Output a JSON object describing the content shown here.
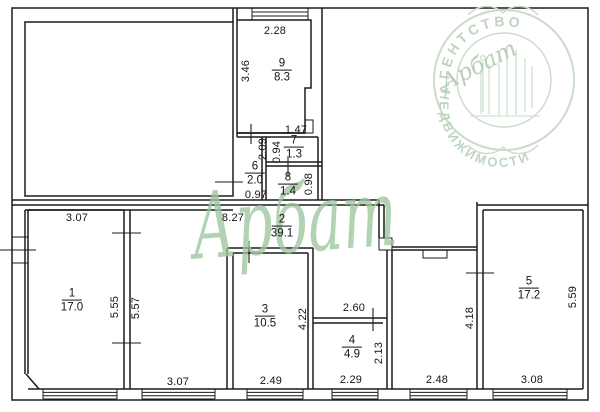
{
  "watermark": {
    "text": "Арбат"
  },
  "logo": {
    "top_text": "АГЕНТСТВО",
    "bottom_text": "НЕДВИЖИМОСТИ",
    "brand_script": "Арбат"
  },
  "colors": {
    "wall": "#1b1b1b",
    "watermark_green": "#9ec69e",
    "logo_green": "#c3d8c3"
  },
  "rooms": [
    {
      "number": "9",
      "area": "8.3"
    },
    {
      "number": "7",
      "area": "1.3"
    },
    {
      "number": "6",
      "area": "2.0"
    },
    {
      "number": "8",
      "area": "1.4"
    },
    {
      "number": "2",
      "area": "39.1"
    },
    {
      "number": "1",
      "area": "17.0"
    },
    {
      "number": "3",
      "area": "10.5"
    },
    {
      "number": "4",
      "area": "4.9"
    },
    {
      "number": "5",
      "area": "17.2"
    }
  ],
  "dims": {
    "room9_width": "2.28",
    "room9_depth": "3.46",
    "room7_width": "1.47",
    "room7_depth": "0.94",
    "room6_depth": "2.09",
    "room6_width": "0.97",
    "room8_depth": "0.98",
    "corridor_length": "8.27",
    "room1_width": "3.07",
    "room1_depth": "5.55",
    "hall_depth": "5.57",
    "hall_width": "3.07",
    "room3_width": "2.49",
    "room3_depth": "4.22",
    "room4_top_width": "2.60",
    "room4_depth": "2.13",
    "room4_width": "2.29",
    "passage_width": "2.48",
    "passage_depth": "4.18",
    "room5_width": "3.08",
    "room5_depth": "5.59"
  }
}
